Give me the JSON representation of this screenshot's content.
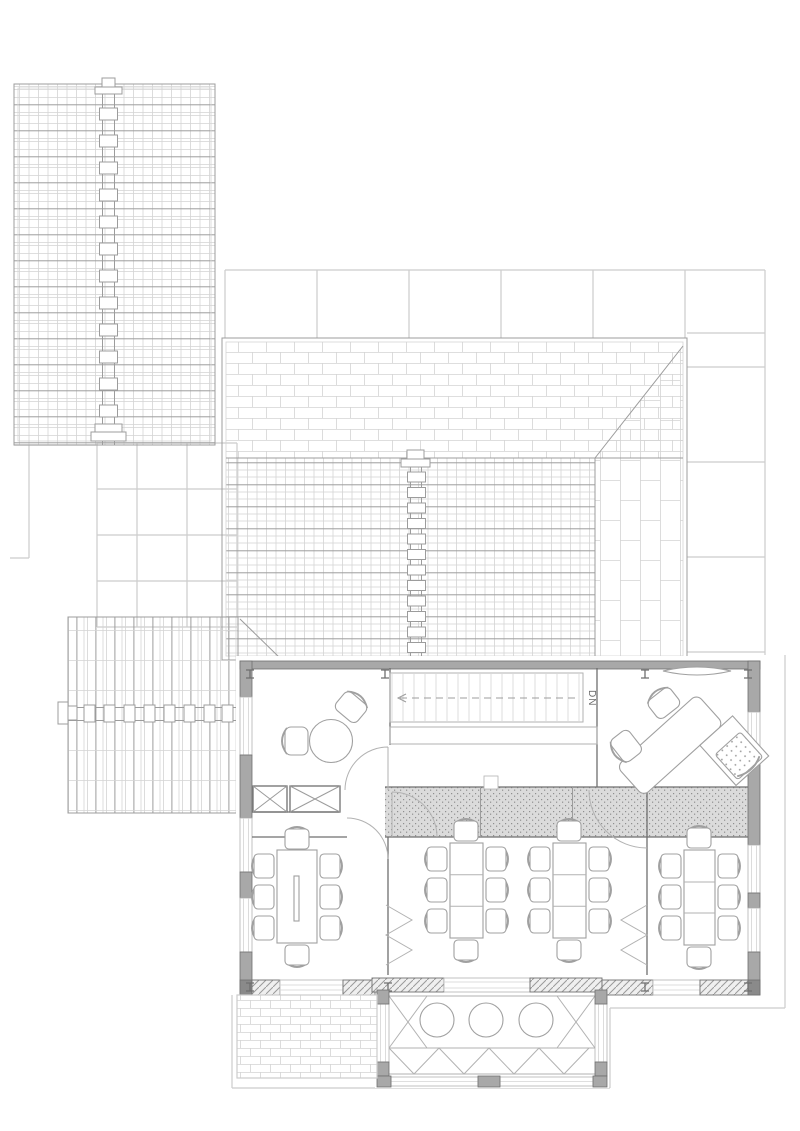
{
  "labels": {
    "stair_direction": "DN"
  },
  "colors": {
    "background": "#ffffff",
    "faint": "#cccccc",
    "roof-light": "#d4d4d4",
    "roof-med": "#9c9c9c",
    "line": "#b2b2b2",
    "dark": "#6f6f6f",
    "wall": "#a8a8a8",
    "wall-dark": "#8a8a8a",
    "furn": "#a0a0a0",
    "stipple-bg": "#dbdbdb",
    "stipple-dot": "#8f8f8f",
    "hatch-line": "#9a9a9a",
    "text": "#6a6a6a"
  },
  "inventory": {
    "roofs": [
      "northwest-gable-roof-with-ridge-cap",
      "main-hip-roof-with-shingle-and-tile-hatch",
      "west-annex-gable-roof"
    ],
    "site": [
      "terrace-grid-paving",
      "brick-paved-patio",
      "site-boundary-lines"
    ],
    "spaces": [
      {
        "name": "meeting-room",
        "furniture": [
          "round-table",
          "armchair",
          "armchair",
          "duct-shaft-x2",
          "door"
        ]
      },
      {
        "name": "stair-hall",
        "furniture": [
          "staircase-17-treads",
          "handrail"
        ],
        "label": "DN"
      },
      {
        "name": "office",
        "furniture": [
          "rotated-desk",
          "desk-return",
          "task-chair-dotted",
          "armchair",
          "armchair",
          "wall-shelf"
        ]
      },
      {
        "name": "conference-room-west",
        "furniture": [
          "long-table-with-cable-slot",
          "chair-x8",
          "folding-partition"
        ]
      },
      {
        "name": "classroom-center",
        "furniture": [
          "modular-table-3-sections",
          "chair-x8",
          "modular-table-3-sections",
          "chair-x8"
        ]
      },
      {
        "name": "conference-room-east",
        "furniture": [
          "modular-table-3-sections",
          "chair-x8",
          "folding-partition",
          "door"
        ]
      },
      {
        "name": "corridor",
        "furniture": [
          "stippled-floor-band",
          "door-swing-x2",
          "wall-marker"
        ]
      },
      {
        "name": "sunroom",
        "furniture": [
          "cafe-round-table-x3",
          "glazing-truss-frame"
        ]
      }
    ]
  }
}
